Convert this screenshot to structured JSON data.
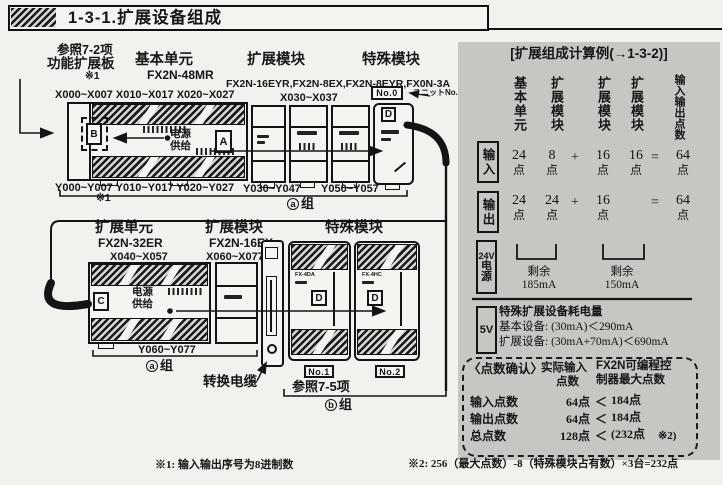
{
  "page": {
    "title": "1-3-1.扩展设备组成"
  },
  "diagram": {
    "ref_note": {
      "line1": "参照7-2项",
      "line2": "功能扩展板",
      "mark": "※1"
    },
    "row1": {
      "headings": {
        "basic": "基本单元",
        "basic_model": "FX2N-48MR",
        "exp": "扩展模块",
        "special": "特殊模块",
        "models": "FX2N-16EYR,FX2N-8EX,FX2N-8EYR,FX0N-3A"
      },
      "io": {
        "x_top": "X000~X007 X010~X017 X020~X027",
        "x_top2": "X030~X037",
        "y_bottom": "Y000~Y007 Y010~Y017 Y020~Y027",
        "note_mark": "※1",
        "y_bottom2": "Y030~Y047",
        "y_bottom3": "Y050~Y057"
      },
      "unit_no": {
        "box": "No.0",
        "label": "ユニットNo."
      },
      "power": {
        "l1": "电源",
        "l2": "供给"
      },
      "tags": {
        "a": "A",
        "b": "B",
        "d": "D"
      },
      "group": {
        "letter": "a",
        "word": "组"
      }
    },
    "row2": {
      "headings": {
        "exp_unit": "扩展单元",
        "exp_unit_model": "FX2N-32ER",
        "exp": "扩展模块",
        "exp_model": "FX2N-16EX",
        "special": "特殊模块"
      },
      "io": {
        "x1": "X040~X057",
        "x2": "X060~X077",
        "y1": "Y060~Y077"
      },
      "power": {
        "l1": "电源",
        "l2": "供给"
      },
      "tags": {
        "c": "C",
        "d": "D"
      },
      "specials": {
        "m1": "FX-4DA",
        "m2": "FX-4HC",
        "no1": "No.1",
        "no2": "No.2"
      },
      "cable_label": "转换电缆",
      "ref75": "参照7-5项",
      "group_a": {
        "letter": "a",
        "word": "组"
      },
      "group_b": {
        "letter": "b",
        "word": "组"
      }
    }
  },
  "panel": {
    "header": "[扩展组成计算例(→1-3-2)]",
    "col_headers": [
      "基本单元",
      "扩展模块",
      "扩展模块",
      "扩展模块",
      "输入输出点数"
    ],
    "unit": "点",
    "calc_rows": [
      {
        "label": "输入",
        "v1": "24",
        "v2": "8",
        "op": "+",
        "v3": "16",
        "v4": "16",
        "eq": "=",
        "total": "64"
      },
      {
        "label": "输出",
        "v1": "24",
        "v2": "24",
        "op": "+",
        "v3": "16",
        "v4": "",
        "eq": "=",
        "total": "64"
      }
    ],
    "power": {
      "label_24v": "24V",
      "label_c1": "电",
      "label_c2": "源",
      "left_caption": "剩余",
      "left_value": "185mA",
      "right_caption": "剩余",
      "right_value": "150mA"
    },
    "five_v": {
      "label": "5V",
      "title": "特殊扩展设备耗电量",
      "line_basic": "基本设备: (30mA)＜290mA",
      "line_exp": "扩展设备: (30mA+70mA)＜690mA"
    },
    "check": {
      "title": "〈点数确认〉",
      "col_actual_1": "实际输入",
      "col_actual_2": "点数",
      "col_max_1": "FX2N可编程控",
      "col_max_2": "制器最大点数",
      "rows": [
        {
          "name": "输入点数",
          "actual": "64点",
          "cmp": "＜",
          "max": "184点",
          "note": ""
        },
        {
          "name": "输出点数",
          "actual": "64点",
          "cmp": "＜",
          "max": "184点",
          "note": ""
        },
        {
          "name": "总点数",
          "actual": "128点",
          "cmp": "＜",
          "max": "(232点",
          "note": "※2)"
        }
      ]
    }
  },
  "footnotes": {
    "f1": "※1: 输入输出序号为8进制数",
    "f2": "※2: 256（最大点数）-8（特殊模块占有数）×3台=232点"
  }
}
